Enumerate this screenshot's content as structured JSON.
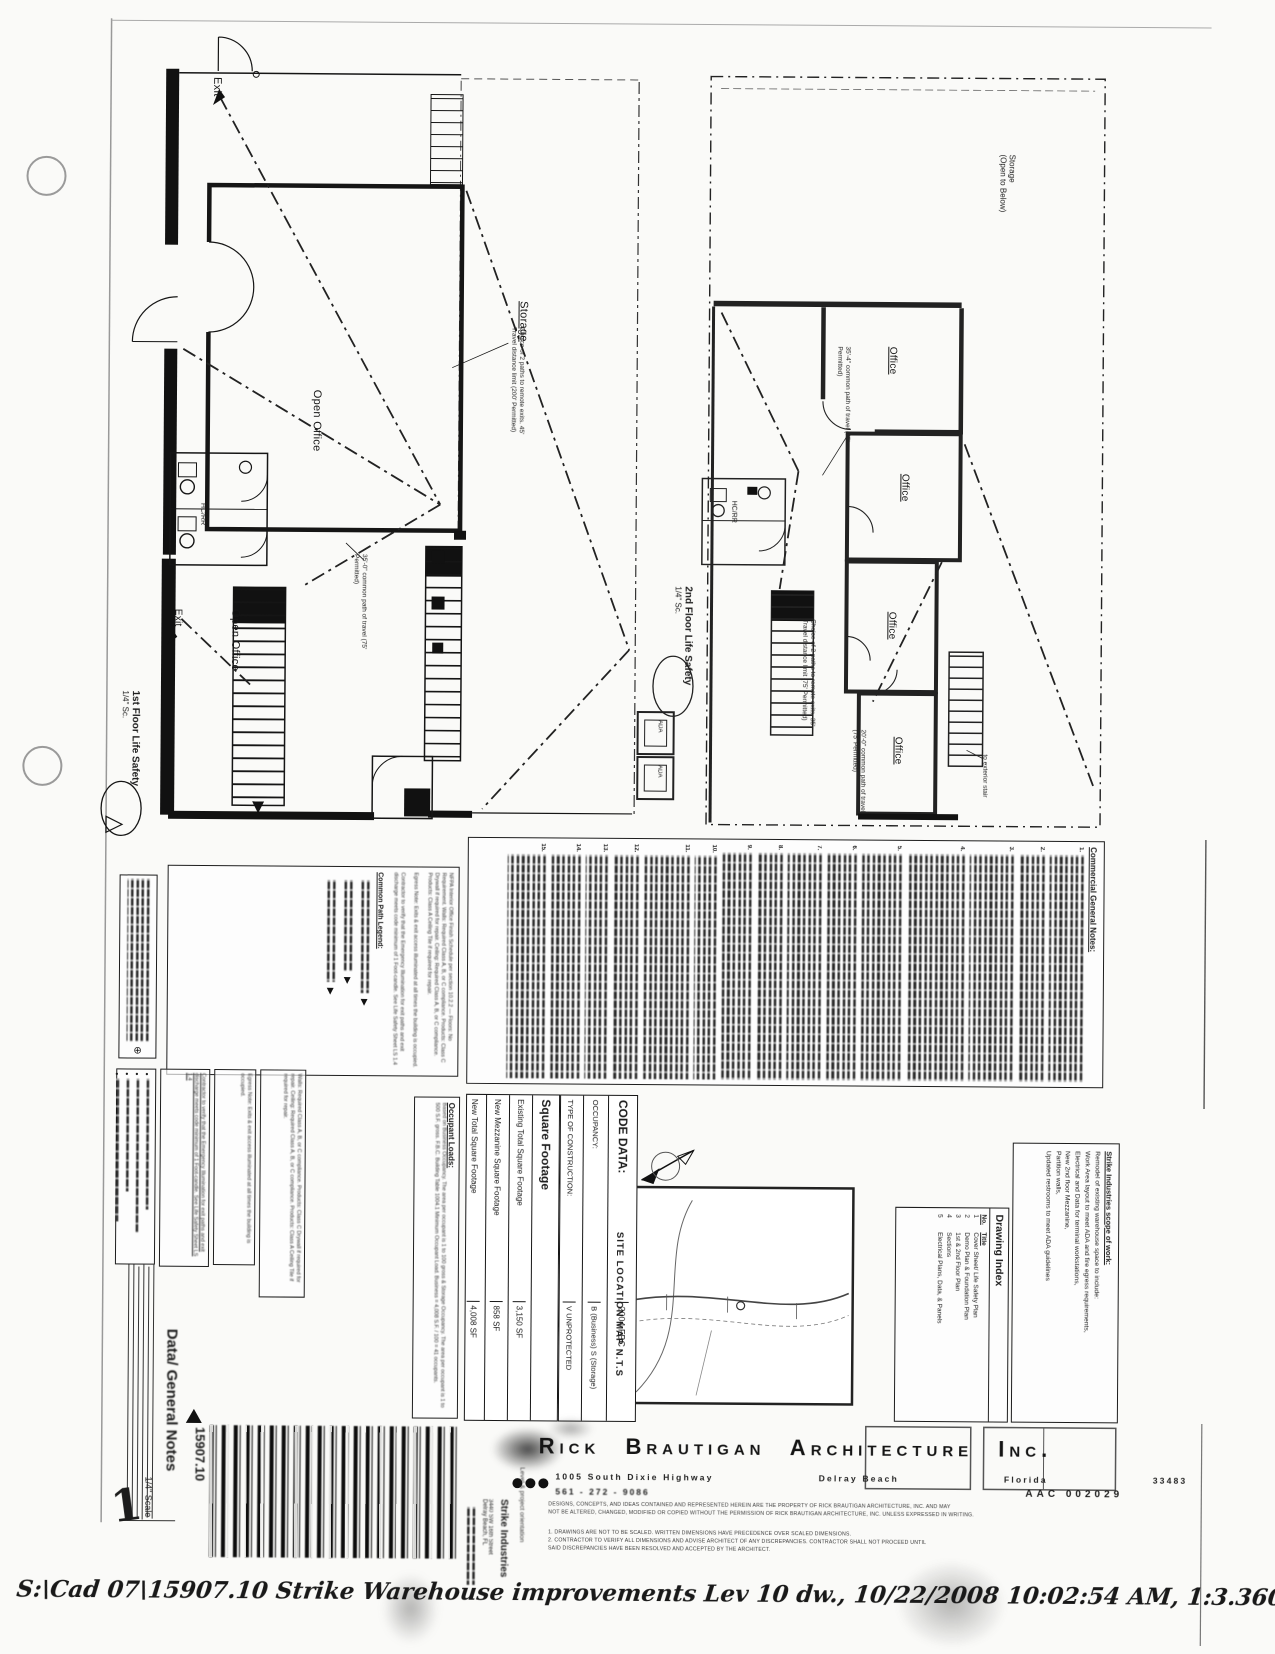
{
  "plans": {
    "first": {
      "title": "1st Floor Life Safety",
      "scale": "1/4\" Sc.",
      "labels": {
        "exit_top": "Exit",
        "exit_left": "Exit",
        "storage": "Storage",
        "open_office_1": "Open Office",
        "open_office_2": "Open Office",
        "restroom": "HC/RR"
      },
      "annotations": {
        "storage_paths": "Choice of 2 paths to remote exits. 45' Travel distance limit (200' Permitted)",
        "common_path": "35'-0\" common path of travel (75' Permitted)"
      }
    },
    "second": {
      "title": "2nd Floor Life Safety",
      "scale": "1/4\" Sc.",
      "labels": {
        "storage_open_1": "Storage",
        "storage_open_2": "(Open to Below)",
        "office_1": "Office",
        "office_2": "Office",
        "office_3": "Office",
        "office_4": "Office",
        "restroom": "HC/RR",
        "ada_box_1": "ADA",
        "ada_box_2": "ADA",
        "stair_note": "to exterior stair"
      },
      "annotations": {
        "common_path_upper": "35'-4\" common path of travel (75' Permitted)",
        "two_paths": "Choice of 2 paths to remote exits. 35' Travel distance limit (75' Permitted)",
        "common_path_lower": "20'-0\" common path of travel (75' Permitted)"
      }
    }
  },
  "general_notes": {
    "title": "Commercial General Notes:",
    "item_numbers": [
      "1.",
      "2.",
      "3.",
      "4.",
      "5.",
      "6.",
      "7.",
      "8.",
      "9.",
      "10.",
      "11.",
      "12.",
      "13.",
      "14.",
      "15."
    ]
  },
  "legend": {
    "title": "Common Path Legend:",
    "finish_schedule": "NFPA Interior Office Finish Schedule per section 10.2.2 — Floors: No Requirement. Walls: Required Class A, B, or C compliance. Products: Class C Drywall if required for repair. Ceiling: Required Class A, B, or C compliance. Products: Class A Ceiling Tile if required for repair.",
    "egress_note": "Egress Note: Exits & exit access illuminated at all times the building is occupied.",
    "illumination_note": "Contractor to verify that the Emergency Illumination for exit paths and exit discharge meets code minimum of 1 Foot-candle. See Life Safety Sheet LS 1.4",
    "walls_note": "Walls: Required Class A, B, or C compliance. Products: Class C Drywall if required for repair. Ceiling: Required Class A, B, or C compliance. Products: Class A Ceiling Tile if required for repair."
  },
  "occupant_loads": {
    "title": "Occupant Loads:",
    "body": "Based on Business Occupancy. The area per occupant is 1 to 100 gross & Storage Occupancy. The area per occupant is 1 to 500 S.F. gross. F.B.C. Building Table 1004.1 Minimum Occupant Load. Business = 4,008 S.F. / 100 = 41 occupants."
  },
  "square_footage": {
    "title": "Square Footage",
    "rows": [
      {
        "label": "Existing Total Square Footage",
        "value": "3,150 SF"
      },
      {
        "label": "New Mezzanine Square Footage",
        "value": "858 SF"
      },
      {
        "label": "New Total Square Footage",
        "value": "4,008 SF"
      }
    ]
  },
  "code_data": {
    "rows": [
      {
        "label": "CODE DATA:",
        "value": "2004 FBC"
      },
      {
        "label": "OCCUPANCY:",
        "value": "B (Business) S (Storage)"
      },
      {
        "label": "TYPE OF CONSTRUCTION:",
        "value": "V  UNPROTECTED"
      }
    ]
  },
  "site_map": {
    "label": "SITE LOCATION MAP N.T.S"
  },
  "drawing_index": {
    "title": "Drawing Index",
    "col_no": "No.",
    "col_title": "Title",
    "rows": [
      {
        "no": "1",
        "title": "Cover Sheet/ Life Safety Plan"
      },
      {
        "no": "2",
        "title": "Demo Plan & Foundation Plan"
      },
      {
        "no": "3",
        "title": "1st & 2nd Floor Plan"
      },
      {
        "no": "4",
        "title": "Sections"
      },
      {
        "no": "5",
        "title": "Electrical Plans, Data, & Panels"
      }
    ]
  },
  "scope": {
    "title": "Strike Industries scope of work:",
    "lines": [
      "Remodel of existing warehouse space to include:",
      "Work Area layout to meet ADA and fire egress requirements,",
      "Electrical and Data for terminal workstations,",
      "New 2nd floor Mezzanine,",
      "Partition walls,",
      "Updated restrooms to meet ADA guidelines"
    ]
  },
  "title_block": {
    "sheet_title": "Data/ General Notes",
    "sheet_scale": "1/4\" Scale",
    "sheet_number": "1",
    "project_number": "15907.10",
    "project_name": "Strike Industries",
    "project_address_1": "3440 SW 16th Street",
    "project_address_2": "Delray Beach, FL",
    "orientation_note": "Level & project orientation"
  },
  "architect": {
    "name": "Rick Brautigan Architecture Inc.",
    "address": "1005 South Dixie Highway",
    "city": "Delray Beach",
    "state": "Florida",
    "zip": "33483",
    "phone": "561 - 272 - 9086",
    "license": "AAC 002029",
    "legal_1": "DESIGNS, CONCEPTS, AND IDEAS CONTAINED AND REPRESENTED HEREIN ARE THE PROPERTY OF RICK BRAUTIGAN ARCHITECTURE, INC. AND MAY",
    "legal_2": "NOT BE ALTERED, CHANGED, MODIFIED OR COPIED WITHOUT THE PERMISSION OF RICK BRAUTIGAN ARCHITECTURE, INC. UNLESS EXPRESSED IN WRITING.",
    "note_1": "1. DRAWINGS ARE NOT TO BE SCALED. WRITTEN DIMENSIONS HAVE PRECEDENCE OVER SCALED DIMENSIONS.",
    "note_2": "2. CONTRACTOR TO VERIFY ALL DIMENSIONS AND ADVISE ARCHITECT OF ANY DISCREPANCIES. CONTRACTOR SHALL NOT PROCEED UNTIL",
    "note_3": "SAID DISCREPANCIES HAVE BEEN RESOLVED AND ACCEPTED BY THE ARCHITECT."
  },
  "plot_stamp": "S:\\Cad 07\\15907.10 Strike Warehouse improvements Lev 10 dw., 10/22/2008 10:02:54 AM, 1:3.36069"
}
